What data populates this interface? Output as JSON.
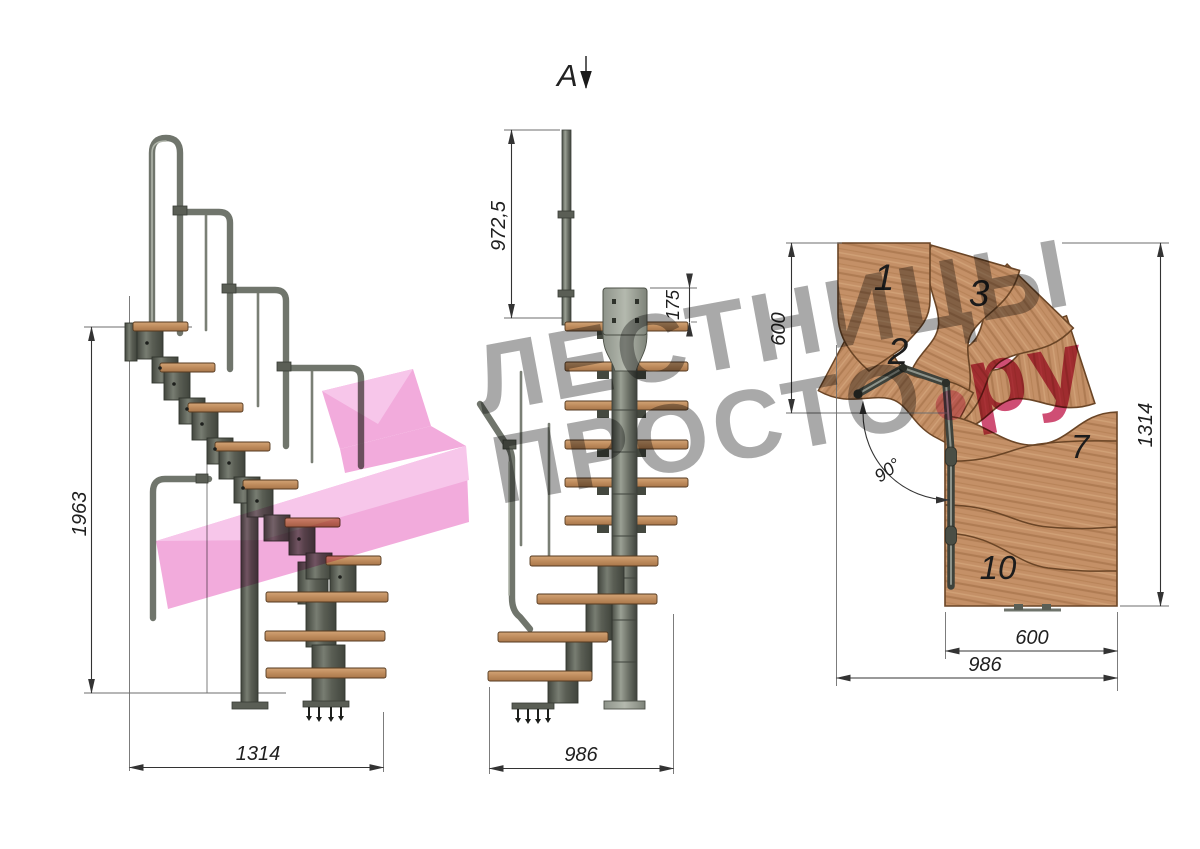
{
  "watermark": {
    "line1": "ЛЕСТНИЦЫ",
    "line2_gray": "ПРОСТО",
    "line2_dot": ".",
    "line2_pink": "ру"
  },
  "views": {
    "side": {
      "title": "side elevation",
      "height_dim": "1963",
      "width_dim": "1314"
    },
    "front": {
      "title": "front elevation",
      "section_label": "А",
      "post_height_dim": "972,5",
      "plate_height_dim": "175",
      "width_dim": "986"
    },
    "plan": {
      "title": "plan view",
      "entry_depth_dim": "600",
      "total_length_dim": "1314",
      "turn_angle_dim": "90°",
      "tread_width_dim": "600",
      "total_width_dim": "986",
      "step_labels": {
        "step1": "1",
        "step2": "2",
        "step3": "3",
        "step7": "7",
        "step10": "10"
      }
    }
  },
  "colors": {
    "wood": "#c49067",
    "wood_dark": "#a9774b",
    "steel": "#575b52",
    "steel_dark": "#3c403a",
    "watermark_gray": "#a9a9a9",
    "watermark_pink": "#f2abdc",
    "brand_crimson": "#cf4e74",
    "dot_pink": "#f0a2c6",
    "dim_line": "#333333"
  }
}
